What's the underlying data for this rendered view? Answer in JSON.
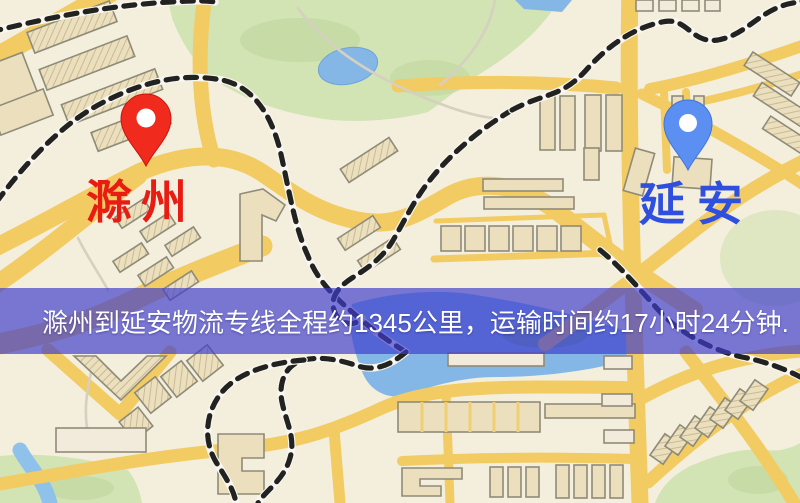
{
  "map": {
    "markers": [
      {
        "name": "origin",
        "label": "滁州",
        "color": "#e81c12",
        "pin_color": "#f02b1d",
        "pin_icon": "red-map-pin-icon"
      },
      {
        "name": "destination",
        "label": "延安",
        "color": "#2f4fdf",
        "pin_color": "#5b8ff2",
        "pin_icon": "blue-map-pin-icon"
      }
    ],
    "banner": {
      "text": "滁州到延安物流专线全程约1345公里，运输时间约17小时24分钟.",
      "bg": "rgba(62,60,205,0.68)",
      "text_color": "#ffffff"
    },
    "palette": {
      "background": "#f4eedd",
      "road": "#f2cb62",
      "building_fill": "#ebdfbe",
      "building_stroke": "#8f8b79",
      "park": "#d2e3b4",
      "park_dark": "#c2d7a0",
      "water": "#85b7e6",
      "railway_dark": "#222220",
      "railway_light": "#f8f6ef"
    }
  }
}
